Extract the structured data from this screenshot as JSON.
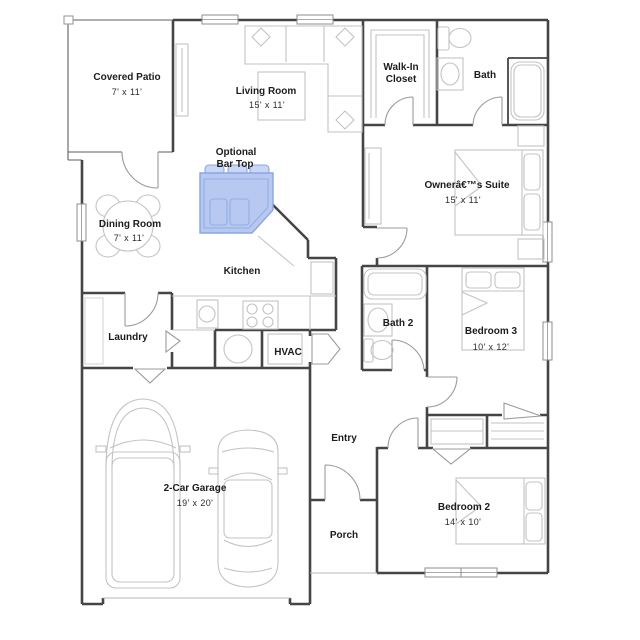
{
  "rooms": {
    "covered_patio": {
      "name": "Covered Patio",
      "dims": "7' x 11'"
    },
    "living_room": {
      "name": "Living Room",
      "dims": "15' x 11'"
    },
    "walk_in_closet": {
      "line1": "Walk-In",
      "line2": "Closet"
    },
    "bath": {
      "name": "Bath"
    },
    "owners_suite": {
      "name": "Ownerâ€™s Suite",
      "dims": "15' x 11'"
    },
    "optional_bar_top": {
      "line1": "Optional",
      "line2": "Bar Top"
    },
    "dining_room": {
      "name": "Dining Room",
      "dims": "7' x 11'"
    },
    "kitchen": {
      "name": "Kitchen"
    },
    "laundry": {
      "name": "Laundry"
    },
    "hvac": {
      "name": "HVAC"
    },
    "bath2": {
      "name": "Bath 2"
    },
    "bedroom3": {
      "name": "Bedroom 3",
      "dims": "10' x 12'"
    },
    "entry": {
      "name": "Entry"
    },
    "garage": {
      "name": "2-Car Garage",
      "dims": "19' x 20'"
    },
    "porch": {
      "name": "Porch"
    },
    "bedroom2": {
      "name": "Bedroom 2",
      "dims": "14' x 10'"
    }
  },
  "colors": {
    "wall": "#454545",
    "furniture": "#c3c3c3",
    "door": "#9b9b9b",
    "text": "#1c1c1c",
    "highlight_fill": "#b7c9f0",
    "highlight_stroke": "#8aa6e2"
  }
}
